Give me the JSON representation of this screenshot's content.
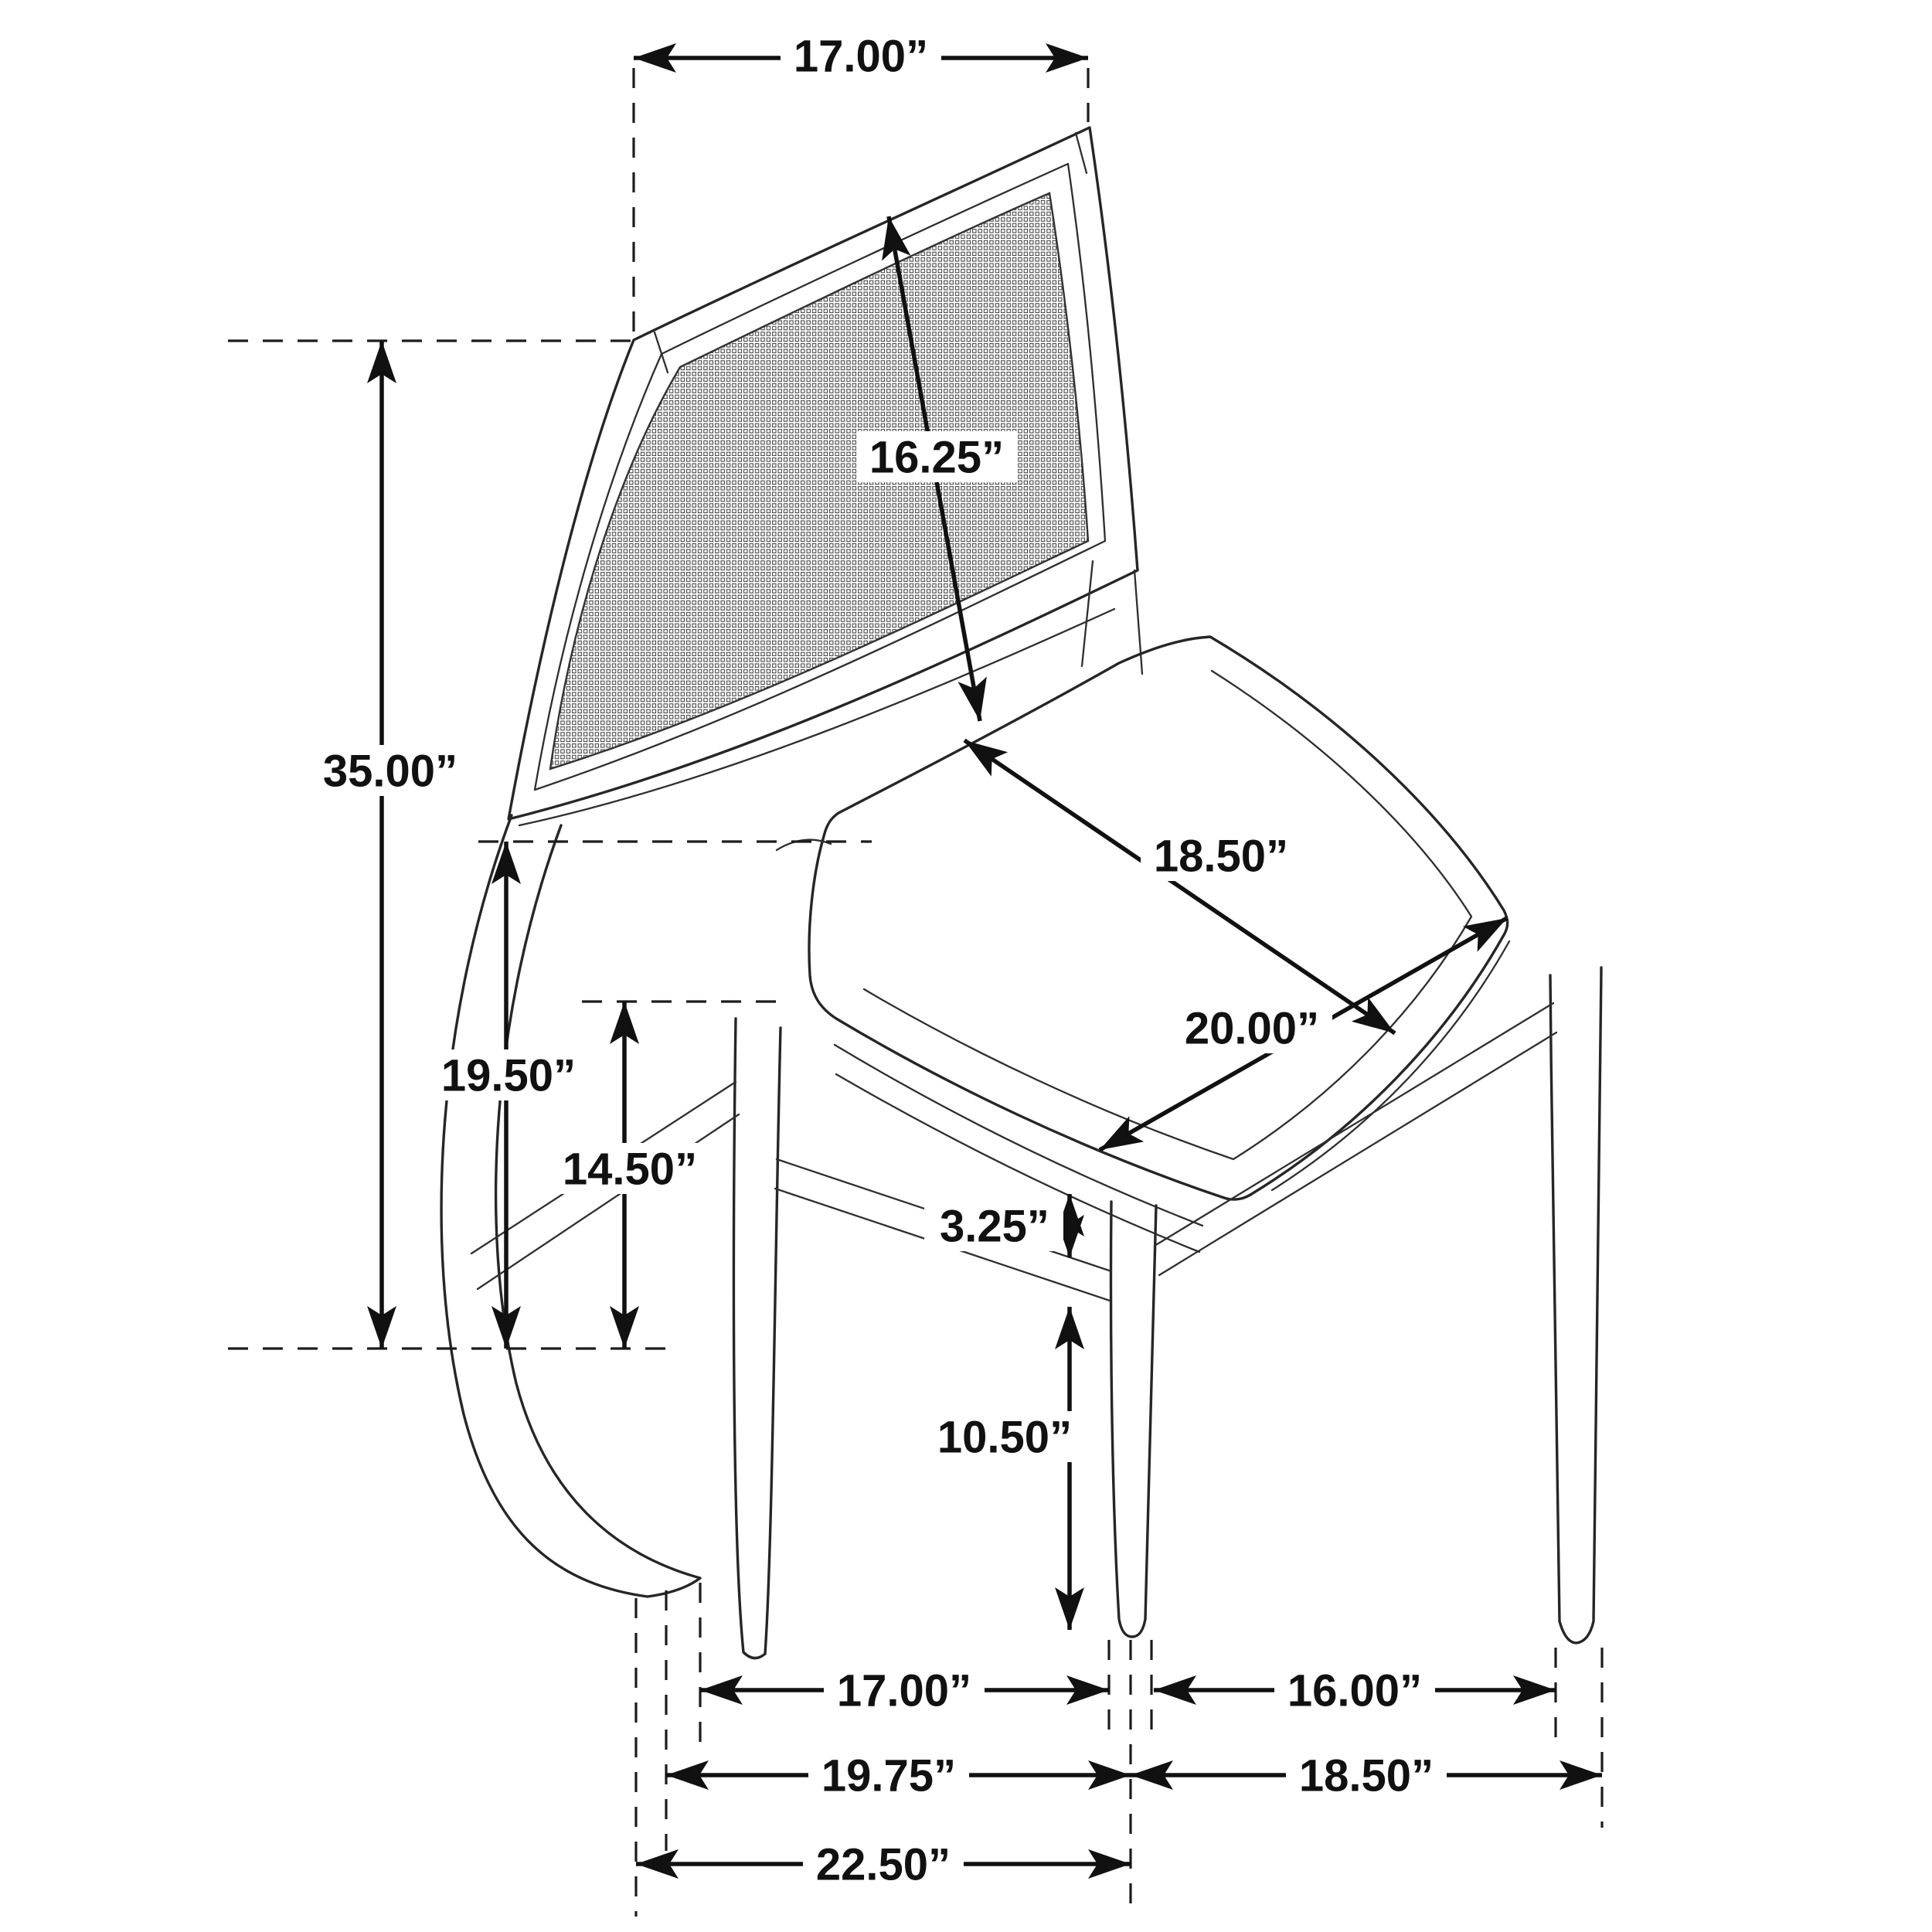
{
  "figure": {
    "type": "furniture dimension diagram",
    "subject": "cane-back upholstered dining side chair, three-quarter view line drawing",
    "unit": "inches",
    "ink_color": "#111111",
    "line_color": "#262626",
    "background": "#ffffff"
  },
  "labels": {
    "back_top_width": "17.00”",
    "back_panel_diagonal": "16.25”",
    "overall_height": "35.00”",
    "seat_back_height": "19.50”",
    "stretcher_top_height": "14.50”",
    "seat_depth": "18.50”",
    "seat_width": "20.00”",
    "apron_stretcher_gap": "3.25”",
    "lower_leg_height": "10.50”",
    "side_leg_spacing": "17.00”",
    "front_to_back_leg_spacing": "16.00”",
    "side_depth": "19.75”",
    "base_width": "18.50”",
    "overall_depth": "22.50”"
  }
}
